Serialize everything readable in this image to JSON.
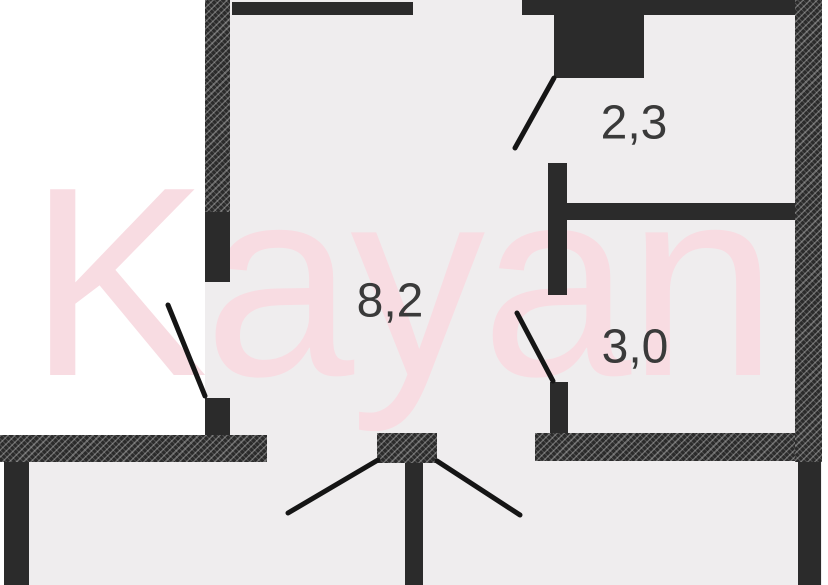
{
  "watermark": {
    "text": "Kayan"
  },
  "rooms": [
    {
      "area_label": "2,3"
    },
    {
      "area_label": "8,2"
    },
    {
      "area_label": "3,0"
    }
  ],
  "colors": {
    "wall": "#2b2b2b",
    "door_line": "#151515",
    "interior": "#efedee",
    "exterior": "#ffffff",
    "watermark_pink": "#f8dce2",
    "label_text": "#3a3a3a"
  }
}
